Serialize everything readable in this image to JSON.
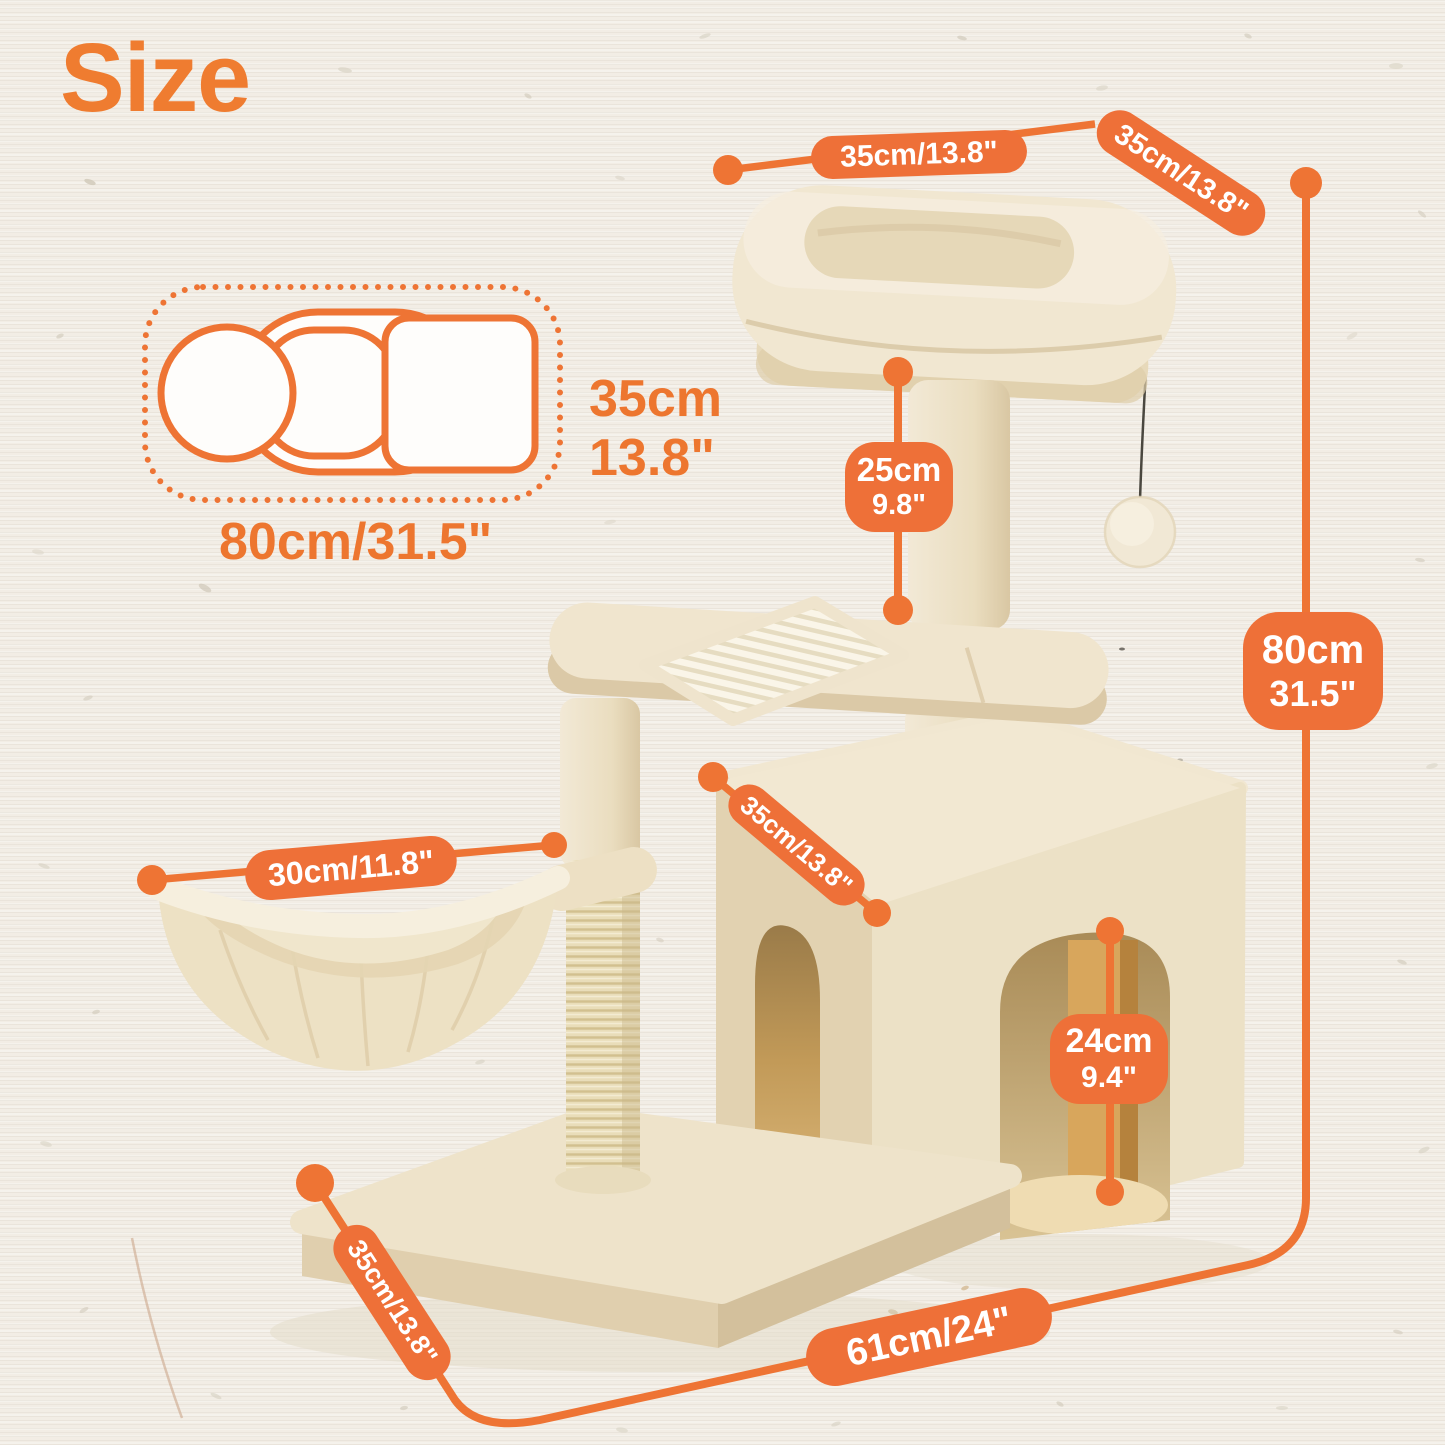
{
  "title": "Size",
  "colors": {
    "accent_orange": "#EE7434",
    "pill_orange": "#EE7038",
    "title_orange": "#EF7C30",
    "label_text": "#FFFFFF",
    "background_paper": "#F2EDE5",
    "plush_beige": "#F0E5CE"
  },
  "top_view_diagram": {
    "depth_label": {
      "line1": "35cm",
      "line2": "13.8\""
    },
    "width_label": "80cm/31.5\""
  },
  "callouts": {
    "bed_width": "35cm/13.8\"",
    "bed_depth": "35cm/13.8\"",
    "upper_post_height": {
      "line1": "25cm",
      "line2": "9.8\""
    },
    "total_height": {
      "line1": "80cm",
      "line2": "31.5\""
    },
    "condo_depth": "35cm/13.8\"",
    "basket_diameter": "30cm/11.8\"",
    "condo_door_height": {
      "line1": "24cm",
      "line2": "9.4\""
    },
    "base_depth": "35cm/13.8\"",
    "base_width": "61cm/24\""
  }
}
